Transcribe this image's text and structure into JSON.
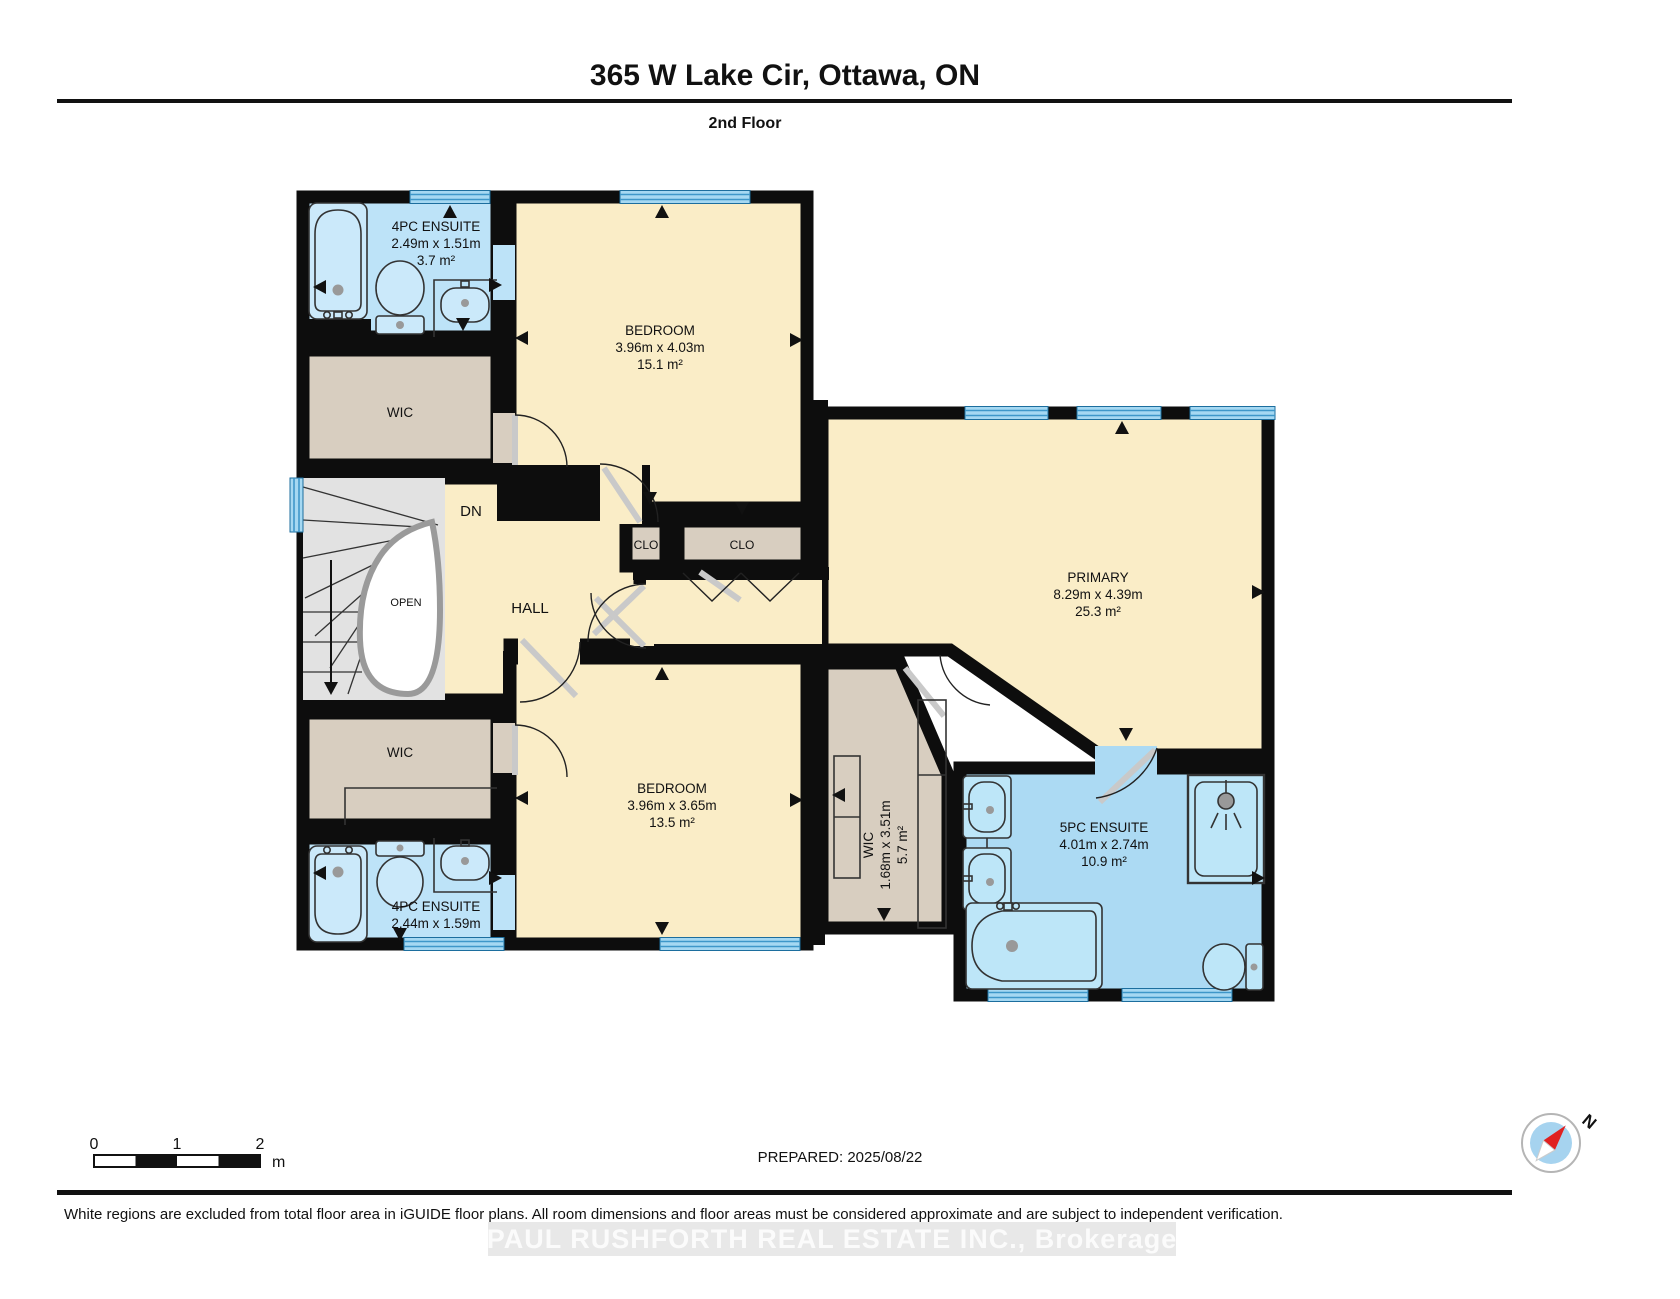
{
  "header": {
    "title": "365 W Lake Cir, Ottawa, ON",
    "floor_label": "2nd Floor"
  },
  "rooms": {
    "ensuite4_top": {
      "name": "4PC ENSUITE",
      "dims": "2.49m x 1.51m",
      "area": "3.7 m²"
    },
    "bedroom_top": {
      "name": "BEDROOM",
      "dims": "3.96m x 4.03m",
      "area": "15.1 m²"
    },
    "wic_top": {
      "name": "WIC"
    },
    "stairs": {
      "dn": "DN",
      "open": "OPEN"
    },
    "hall": {
      "name": "HALL"
    },
    "clo_left": {
      "name": "CLO"
    },
    "clo_right": {
      "name": "CLO"
    },
    "primary": {
      "name": "PRIMARY",
      "dims": "8.29m x 4.39m",
      "area": "25.3 m²"
    },
    "wic_bottom": {
      "name": "WIC"
    },
    "bedroom_bottom": {
      "name": "BEDROOM",
      "dims": "3.96m x 3.65m",
      "area": "13.5 m²"
    },
    "ensuite4_bottom": {
      "name": "4PC ENSUITE",
      "dims": "2.44m x 1.59m"
    },
    "wic_vertical": {
      "name": "WIC",
      "dims": "1.68m x 3.51m",
      "area": "5.7 m²"
    },
    "ensuite5": {
      "name": "5PC ENSUITE",
      "dims": "4.01m x 2.74m",
      "area": "10.9 m²"
    }
  },
  "scale_bar": {
    "tick0": "0",
    "tick1": "1",
    "tick2": "2",
    "unit": "m"
  },
  "footer": {
    "prepared": "PREPARED: 2025/08/22",
    "compass_n": "N",
    "disclaimer": "White regions are excluded from total floor area in iGUIDE floor plans. All room dimensions and floor areas must be considered approximate and are subject to independent verification.",
    "watermark": "PAUL RUSHFORTH REAL ESTATE INC.,  Brokerage"
  },
  "colors": {
    "wall": "#0d0d0d",
    "room_cream": "#FAEDC7",
    "closet_tan": "#D8CEC0",
    "bath_blue": "#BDE3F8",
    "bath_blue_deep": "#ACDAF3",
    "stairs_gray": "#E2E2E2",
    "window_blue": "#A5D8F2",
    "window_stripe": "#3E97C9",
    "compass_red": "#E02020"
  }
}
